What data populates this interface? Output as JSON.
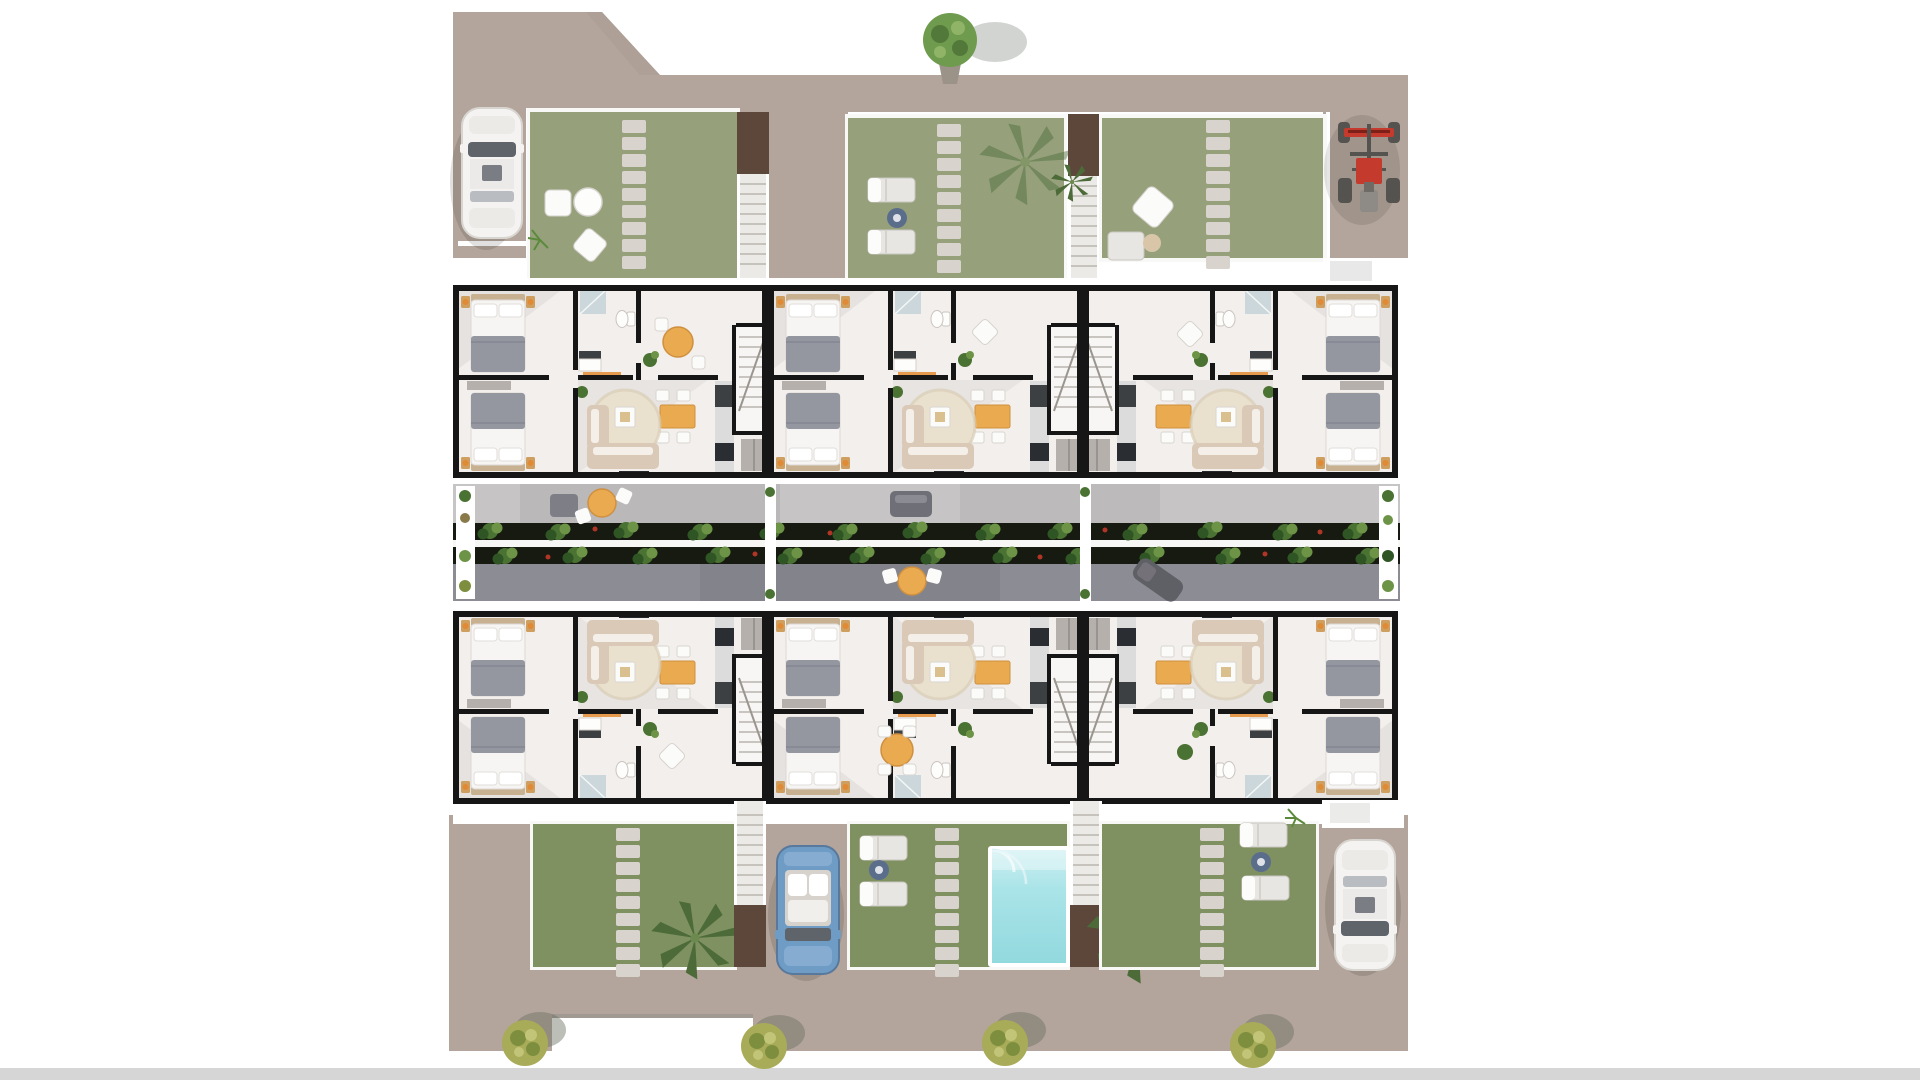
{
  "scene": {
    "type": "3d-aerial-site-floor-plan",
    "apartment_units": {
      "top_row": 3,
      "bottom_row": 3
    },
    "bedrooms_per_unit": 2,
    "vehicles": [
      {
        "id": "car-top-left",
        "kind": "white-car",
        "color_key": "car_white"
      },
      {
        "id": "buggy-top-right",
        "kind": "red-quad-buggy",
        "color_key": "quad_red"
      },
      {
        "id": "car-bottom-center",
        "kind": "blue-car",
        "color_key": "car_blue"
      },
      {
        "id": "car-bottom-right",
        "kind": "white-car",
        "color_key": "car_white"
      }
    ],
    "counts": {
      "top_gardens": 3,
      "bottom_gardens": 3,
      "exterior_staircases": 4,
      "street_trees_bottom_row": 4,
      "street_trees_top": 1,
      "swimming_pools": 1,
      "stepping_stone_paths": 6
    },
    "amenities": [
      "private-gardens",
      "stepping-stone-paths",
      "exterior-staircases",
      "central-terrace-walkways",
      "planter-strips",
      "swimming-pool",
      "parking-bays"
    ]
  },
  "palette": {
    "street": "#b3a59b",
    "street_shade": "#aa9c92",
    "garden_top": "#96a17c",
    "garden_bottom": "#7f9161",
    "stone": "#d9d3cd",
    "stair_landing": "#5c473a",
    "stair_steps": "#eceae7",
    "wall": "#161616",
    "floor": "#f3efec",
    "terrace_upper": "#c7c4c6",
    "terrace_lower": "#8c8c95",
    "planter_dark": "#161a10",
    "bush_green": "#4a7233",
    "bush_light": "#6d9446",
    "flower_red": "#b03527",
    "pool_water": "#9fdfe3",
    "pool_light": "#cdeff1",
    "car_white": "#f4f3f1",
    "car_glass": "#5f646b",
    "car_blue": "#6f9cc5",
    "quad_red": "#c43b2e",
    "quad_dark": "#55534f",
    "tree_green": "#6f9b4e",
    "tree_dark": "#53793a",
    "shrub_yellow": "#a8ab58",
    "shrub_dark": "#7d8f3e",
    "palm_green": "#4c6b38",
    "bed_duvet": "#f6f5f3",
    "bed_blanket": "#9597a0",
    "headboard": "#c8b190",
    "nightstand": "#cf9f5f",
    "lamp": "#e08a35",
    "wardrobe": "#b5b0ac",
    "rug": "#e9e0cd",
    "sofa": "#d9c9b6",
    "table_orange": "#eaaa50",
    "chair_white": "#fbfbfa",
    "kitchen_counter": "#dcdcdc",
    "kitchen_dark": "#3c4043",
    "console_orange": "#e59a4d",
    "tv_dark": "#26282b",
    "shower": "#ccd7db",
    "lounger": "#e8e6e2",
    "side_table_blue": "#5a6e8c",
    "bottom_bar": "#d6d6d6",
    "background": "#ffffff"
  }
}
